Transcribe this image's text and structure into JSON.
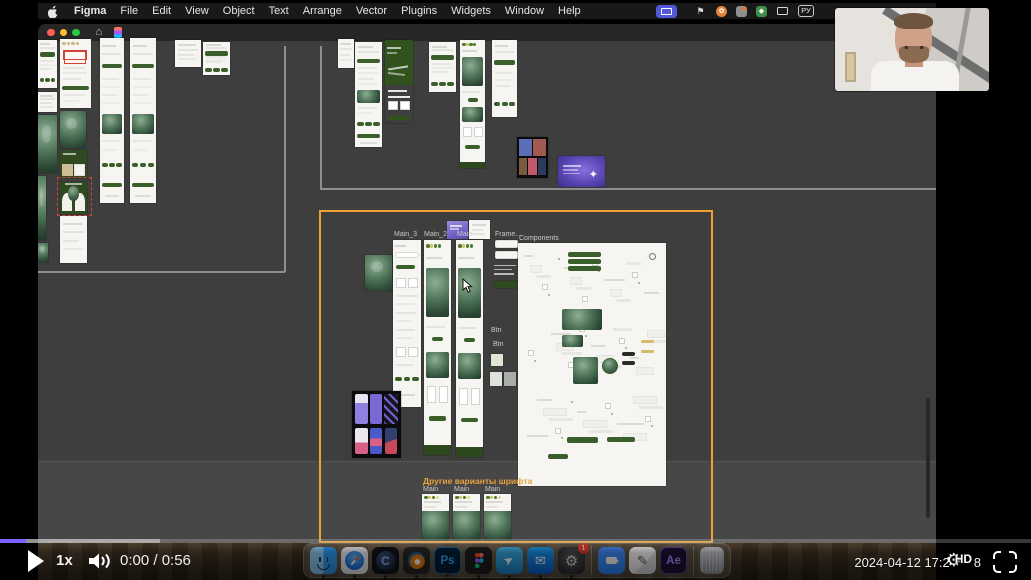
{
  "colors": {
    "progress_accent": "#7b61ff",
    "selection_orange": "#f0a030",
    "design_green": "#3a5f2a"
  },
  "menu_bar": {
    "app_name": "Figma",
    "menus": [
      "File",
      "Edit",
      "View",
      "Object",
      "Text",
      "Arrange",
      "Vector",
      "Plugins",
      "Widgets",
      "Window",
      "Help"
    ],
    "status_icons": [
      "screen-share-indicator",
      "flag-icon",
      "orange-app-icon",
      "camera-app-icon",
      "green-app-icon",
      "display-icon"
    ],
    "input_source_label": "РУ"
  },
  "canvas": {
    "labels": [
      {
        "text": "Main_3",
        "x": 394,
        "y": 231
      },
      {
        "text": "Main_2",
        "x": 424,
        "y": 231
      },
      {
        "text": "Main",
        "x": 457,
        "y": 231
      },
      {
        "text": "Frame...",
        "x": 495,
        "y": 231
      },
      {
        "text": "Components",
        "x": 519,
        "y": 235
      },
      {
        "text": "Btn",
        "x": 491,
        "y": 327
      },
      {
        "text": "Btn",
        "x": 493,
        "y": 341
      },
      {
        "text": "Main",
        "x": 423,
        "y": 486
      },
      {
        "text": "Main",
        "x": 454,
        "y": 486
      },
      {
        "text": "Main",
        "x": 485,
        "y": 486
      }
    ],
    "section_title": {
      "text": "Другие варианты шрифта",
      "x": 423,
      "y": 476,
      "color": "#e8a33d"
    },
    "annotations": [
      {
        "type": "red-box",
        "x": 64,
        "y": 51,
        "w": 22,
        "h": 13
      },
      {
        "type": "red-dashed",
        "x": 57,
        "y": 177,
        "w": 35,
        "h": 39
      }
    ],
    "frames": [
      {
        "x": 38,
        "y": 40,
        "w": 19,
        "h": 48,
        "kind": "white-app"
      },
      {
        "x": 38,
        "y": 92,
        "w": 19,
        "h": 20,
        "kind": "white-doc"
      },
      {
        "x": 38,
        "y": 115,
        "w": 19,
        "h": 58,
        "kind": "teal-photo"
      },
      {
        "x": 38,
        "y": 176,
        "w": 8,
        "h": 64,
        "kind": "teal-photo"
      },
      {
        "x": 38,
        "y": 243,
        "w": 10,
        "h": 19,
        "kind": "teal-photo"
      },
      {
        "x": 60,
        "y": 39,
        "w": 31,
        "h": 69,
        "kind": "white-app-redbox"
      },
      {
        "x": 60,
        "y": 111,
        "w": 26,
        "h": 37,
        "kind": "teal-photo"
      },
      {
        "x": 60,
        "y": 150,
        "w": 27,
        "h": 28,
        "kind": "green-tan"
      },
      {
        "x": 60,
        "y": 182,
        "w": 27,
        "h": 32,
        "kind": "green-arches"
      },
      {
        "x": 60,
        "y": 216,
        "w": 27,
        "h": 47,
        "kind": "white-doc"
      },
      {
        "x": 100,
        "y": 38,
        "w": 24,
        "h": 165,
        "kind": "white-app-tall"
      },
      {
        "x": 130,
        "y": 38,
        "w": 26,
        "h": 165,
        "kind": "white-app-tall"
      },
      {
        "x": 175,
        "y": 40,
        "w": 26,
        "h": 27,
        "kind": "white-doc"
      },
      {
        "x": 203,
        "y": 42,
        "w": 27,
        "h": 33,
        "kind": "white-app"
      },
      {
        "x": 338,
        "y": 39,
        "w": 16,
        "h": 29,
        "kind": "white-doc"
      },
      {
        "x": 355,
        "y": 42,
        "w": 27,
        "h": 105,
        "kind": "white-app-tall"
      },
      {
        "x": 385,
        "y": 40,
        "w": 28,
        "h": 83,
        "kind": "green-app"
      },
      {
        "x": 429,
        "y": 42,
        "w": 27,
        "h": 50,
        "kind": "white-app"
      },
      {
        "x": 460,
        "y": 40,
        "w": 25,
        "h": 128,
        "kind": "green-rich"
      },
      {
        "x": 492,
        "y": 40,
        "w": 25,
        "h": 77,
        "kind": "white-app"
      },
      {
        "x": 517,
        "y": 137,
        "w": 31,
        "h": 41,
        "kind": "dark-board-photos"
      },
      {
        "x": 558,
        "y": 156,
        "w": 47,
        "h": 31,
        "kind": "purple-slide"
      },
      {
        "x": 365,
        "y": 255,
        "w": 27,
        "h": 36,
        "kind": "teal-photo"
      },
      {
        "x": 447,
        "y": 221,
        "w": 21,
        "h": 18,
        "kind": "purple-mini"
      },
      {
        "x": 469,
        "y": 220,
        "w": 21,
        "h": 19,
        "kind": "white-mini"
      },
      {
        "x": 393,
        "y": 240,
        "w": 28,
        "h": 167,
        "kind": "white-wireframe"
      },
      {
        "x": 424,
        "y": 240,
        "w": 27,
        "h": 215,
        "kind": "green-rich"
      },
      {
        "x": 456,
        "y": 240,
        "w": 27,
        "h": 217,
        "kind": "green-rich"
      },
      {
        "x": 495,
        "y": 240,
        "w": 23,
        "h": 8,
        "kind": "white-bar"
      },
      {
        "x": 495,
        "y": 251,
        "w": 23,
        "h": 8,
        "kind": "white-bar"
      },
      {
        "x": 494,
        "y": 264,
        "w": 22,
        "h": 12,
        "kind": "text-rows"
      },
      {
        "x": 494,
        "y": 281,
        "w": 24,
        "h": 7,
        "kind": "green-band"
      },
      {
        "x": 518,
        "y": 243,
        "w": 148,
        "h": 243,
        "kind": "components"
      },
      {
        "x": 491,
        "y": 354,
        "w": 12,
        "h": 12,
        "kind": "swatch",
        "color": "#dfe6d3"
      },
      {
        "x": 490,
        "y": 372,
        "w": 12,
        "h": 14,
        "kind": "swatch",
        "color": "#dde3da"
      },
      {
        "x": 504,
        "y": 372,
        "w": 12,
        "h": 14,
        "kind": "swatch",
        "color": "#a9aeab"
      },
      {
        "x": 352,
        "y": 391,
        "w": 49,
        "h": 67,
        "kind": "dark-board-mockups"
      },
      {
        "x": 422,
        "y": 494,
        "w": 27,
        "h": 46,
        "kind": "green-rich-cut"
      },
      {
        "x": 453,
        "y": 494,
        "w": 27,
        "h": 46,
        "kind": "green-rich-cut"
      },
      {
        "x": 484,
        "y": 494,
        "w": 27,
        "h": 46,
        "kind": "green-rich-cut"
      }
    ]
  },
  "dock": {
    "apps": [
      {
        "id": "finder",
        "running": true
      },
      {
        "id": "safari",
        "running": true
      },
      {
        "id": "cinema4d",
        "glyph": "C",
        "running": true
      },
      {
        "id": "blender",
        "running": true
      },
      {
        "id": "photoshop",
        "glyph": "Ps",
        "running": true
      },
      {
        "id": "figma",
        "running": true
      },
      {
        "id": "telegram",
        "running": true
      },
      {
        "id": "mail",
        "running": true
      },
      {
        "id": "system-settings",
        "badge": "1",
        "running": true
      },
      {
        "id": "separator"
      },
      {
        "id": "zoom",
        "running": false
      },
      {
        "id": "notes",
        "running": false
      },
      {
        "id": "after-effects",
        "glyph": "Ae",
        "running": false
      },
      {
        "id": "separator"
      },
      {
        "id": "trash",
        "running": false
      }
    ]
  },
  "video_player": {
    "progress": {
      "played_percent": 2.5,
      "buffered_percent": 15.5
    },
    "controls": {
      "speed_label": "1x",
      "time_display": "0:00 / 0:56"
    },
    "right": {
      "timestamp_prefix": "2024-04-12 17:2",
      "timestamp_suffix": "8",
      "quality_badge": "HD"
    }
  }
}
